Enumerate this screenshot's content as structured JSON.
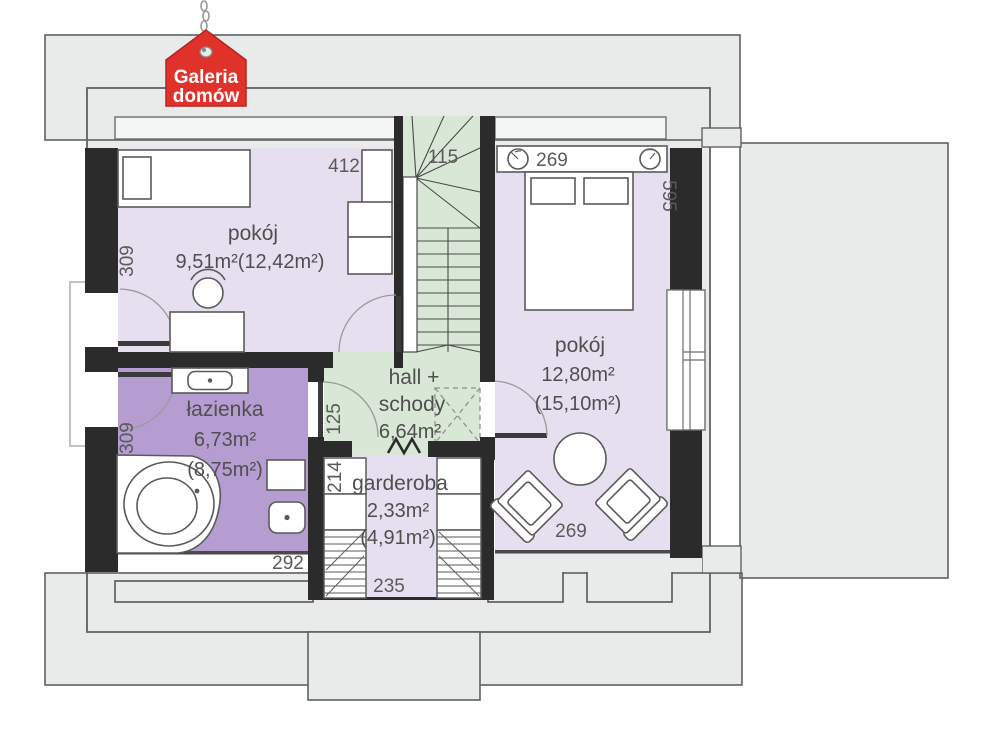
{
  "logo": {
    "line1": "Galeria",
    "line2": "domów"
  },
  "rooms": {
    "pokoj_top_left": {
      "name": "pokój",
      "area": "9,51m²(12,42m²)"
    },
    "pokoj_right": {
      "name": "pokój",
      "area": "12,80m²",
      "area_gross": "(15,10m²)"
    },
    "lazienka": {
      "name": "łazienka",
      "area": "6,73m²",
      "area_gross": "(8,75m²)"
    },
    "hall": {
      "name_line1": "hall +",
      "name_line2": "schody",
      "area": "6,64m²"
    },
    "garderoba": {
      "name": "garderoba",
      "area": "2,33m²",
      "area_gross": "(4,91m²)"
    }
  },
  "dimensions": {
    "pokoj_tl_width": "412",
    "stairs_width": "115",
    "pokoj_r_top": "269",
    "pokoj_r_depth": "595",
    "pokoj_tl_left": "309",
    "lazienka_left": "309",
    "hall_left": "125",
    "garderoba_left": "214",
    "lazienka_bottom": "292",
    "garderoba_bottom": "235",
    "pokoj_r_bottom": "269"
  },
  "colors": {
    "roof_fill": "#e9eaea",
    "wall": "#2b2b2b",
    "room_light_purple": "#e6dff0",
    "bathroom_purple": "#b59dd1",
    "stairs_green": "#d9e8d6",
    "logo_red": "#e0312a"
  }
}
